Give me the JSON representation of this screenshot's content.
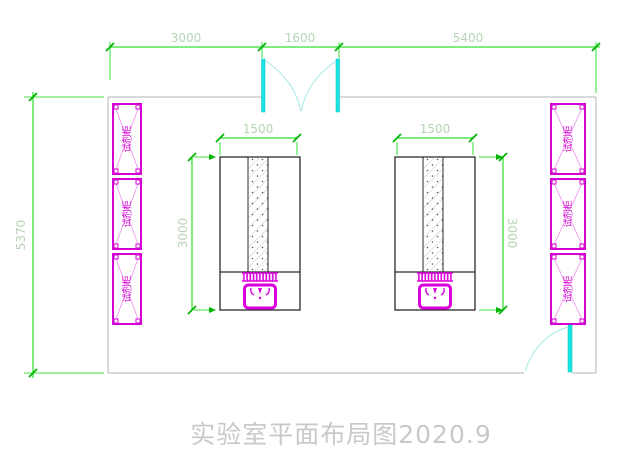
{
  "drawing": {
    "title": "实验室平面布局图2020.9",
    "dimensions": {
      "top": [
        "3000",
        "1600",
        "5400"
      ],
      "room_height": "5370",
      "bench_left": {
        "width": "1500",
        "height": "3000"
      },
      "bench_right": {
        "width": "1500",
        "height": "3000"
      }
    },
    "labels": {
      "cabinet": "试剂柜"
    },
    "colors": {
      "dimension_line": "#00d800",
      "dimension_text": "#b7d4b7",
      "cabinet_magenta": "#d400d4",
      "sink_magenta": "#dc00dc",
      "door_cyan": "#1ae4e4",
      "wall_gray": "#c2c2c2",
      "bench_outline": "#2b2b2b",
      "title_gray": "#c9c9c9"
    }
  }
}
